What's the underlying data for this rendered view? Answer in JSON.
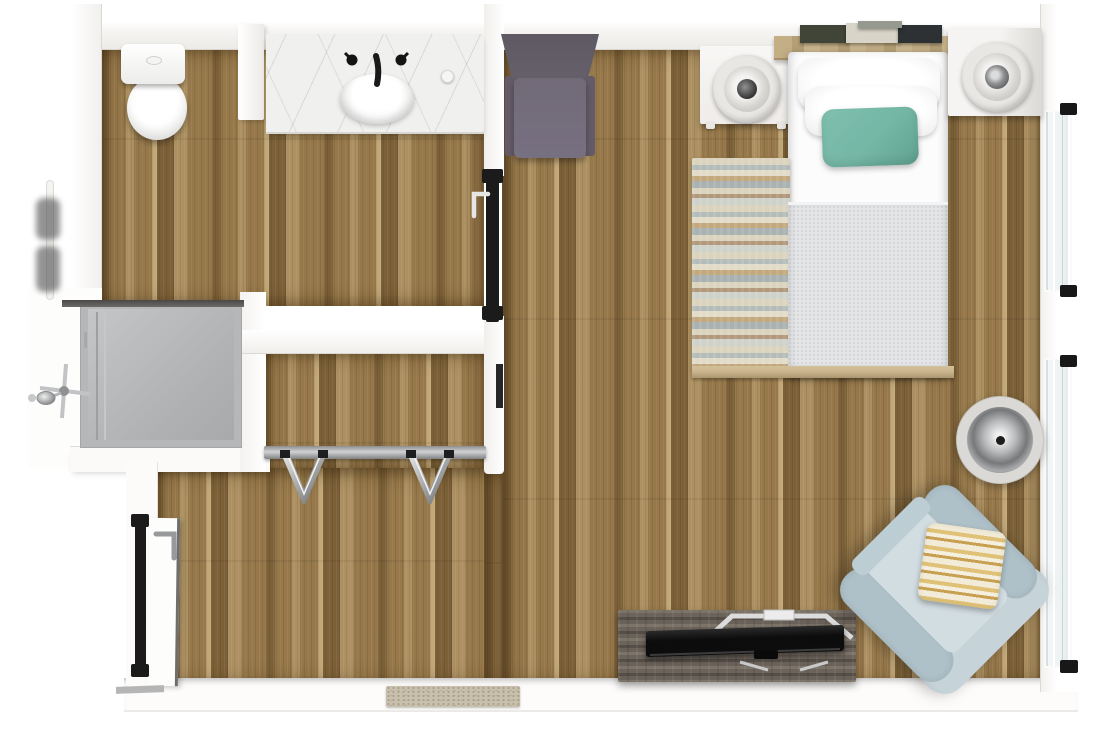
{
  "meta": {
    "description": "Top-down 3D rendering of a studio apartment floor plan",
    "view": "top-down",
    "canvas": "1100x739"
  },
  "palette": {
    "pageBg": "#ffffff",
    "wall": "#ffffff",
    "floorDark": "#7c6138",
    "floorMid": "#96784a",
    "floorLight": "#ad9162",
    "floorPale": "#c2a878",
    "showerPan": "#b6b7b9",
    "showerPanLight": "#c5c6c8",
    "glassDark": "#4a4947",
    "trackBlack": "#1b1b1b",
    "marbleBase": "#f0f0ef",
    "windowGlass": "#edf2f2",
    "teal": "#74b7a5",
    "tealDark": "#5fa28f",
    "mattress": "#fcfcfc",
    "blanket": "#e4e5e7",
    "blanketDot": "#d3d4d7",
    "headboard": "#c3ae86",
    "headboardDark": "#a8916a",
    "bookGreen": "#404538",
    "bookPale": "#d8d4c7",
    "bookBlack": "#2d3134",
    "rugCream": "#dad3be",
    "rugBlue": "#b4bcb9",
    "rugTan": "#c3a87d",
    "rugGray": "#a9b2b1",
    "rugLight": "#e1dbc8",
    "railWood": "#c9b48c",
    "console": "#6c635b",
    "consoleDark": "#554e47",
    "consoleLight": "#7d7469",
    "tvBlack": "#0d0d0d",
    "armchair": "#c6d4da",
    "armchairDeep": "#aec0c8",
    "seatBlue": "#d2dde2",
    "pillowYellow": "#dfc277",
    "pillowYellowDeep": "#c7a052",
    "pillowCream": "#f1ebd7",
    "chairPurple": "#66606b",
    "chairPurpleSeat": "#777081",
    "nightstand": "#f8f7f5",
    "nightstandShade": "#dbd9d5",
    "lampRing": "#e9e7e4",
    "lampInner": "#d5d3cf",
    "lampCore": "#303030",
    "doormat": "#c9bfad"
  },
  "rooms": {
    "bathroom": {
      "label": "Bathroom",
      "items": [
        "toilet",
        "vanity with marble counter",
        "oval sink",
        "faucet",
        "soap dispenser",
        "towel bar with towels",
        "sliding pocket door"
      ]
    },
    "shower": {
      "label": "Shower",
      "items": [
        "gray shower pan",
        "glass screen edge",
        "chrome shower valve and head"
      ]
    },
    "closet": {
      "label": "Closet",
      "items": [
        "closet rod",
        "chrome hanger",
        "chrome hanger"
      ]
    },
    "bedroom": {
      "label": "Bedroom area",
      "items": [
        "gray accent chair",
        "left nightstand with lamp",
        "bed with white pillows",
        "teal throw pillow",
        "gray knit blanket",
        "headboard shelf with books",
        "striped runner rug",
        "right nightstand with lamp"
      ]
    },
    "living": {
      "label": "Living corner",
      "items": [
        "floor lamp",
        "light blue armchair",
        "striped throw pillow",
        "wood media console",
        "flat screen TV"
      ]
    },
    "entry": {
      "label": "Entry",
      "items": [
        "entry door with lever handle",
        "doormat",
        "exterior walkway"
      ]
    },
    "windows": {
      "label": "Windows",
      "count": 2
    }
  }
}
